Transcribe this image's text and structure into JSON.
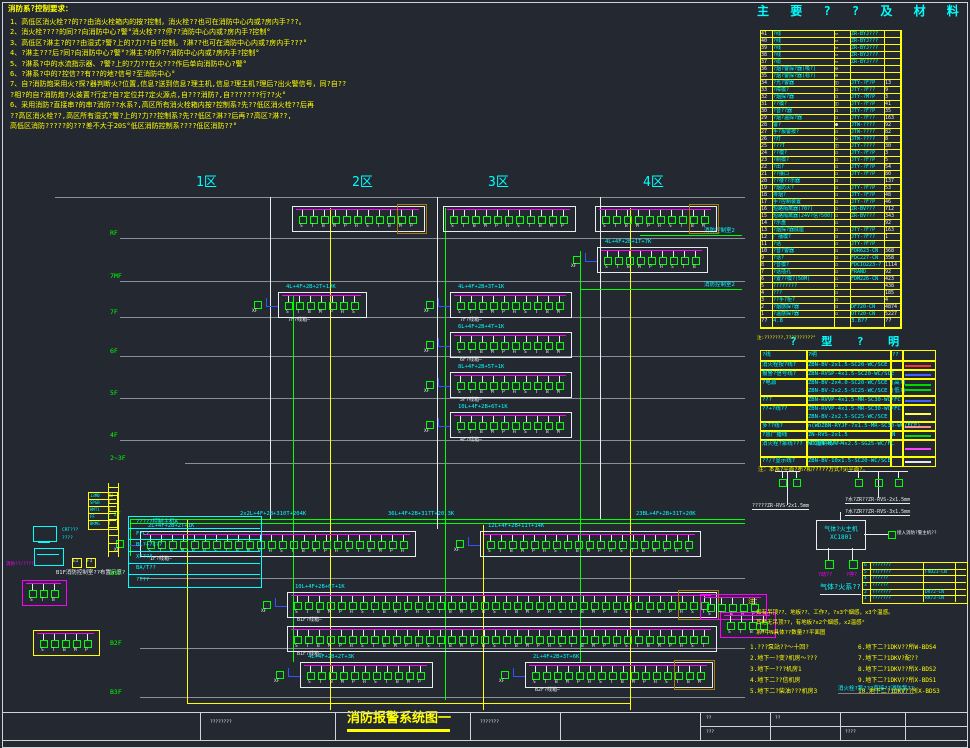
{
  "drawing_title": {
    "text": "消防报警系统图一"
  },
  "notes_top": {
    "header": "消防系?控制要求：",
    "lines": [
      "1、高低区消火栓??的??由消火栓箱内的按?控制，消火栓??也可在消防中心内或?房内手???。",
      "2、消火栓????的同??向消防中心?警°消火栓???停??消防中心内或?房内手?控制°",
      "3、高低区?淋主?的??由湿式?警?上的?力??自?控制。?淋??也可在消防中心内或?房内手???°",
      "4、?淋主???后?同?向消防中心?警°?淋主?的停??消防中心内或?房内手?控制°",
      "5、?淋系?中的水流指示器、?警?上的?力??在火???作后单向消防中心?警°",
      "6、?淋系?中的?控信??有??的地?信号?至消防中心°",
      "7、自?消防炮采用火?探?器判断火?位置,信息?送到信息?理主机,信息?理主机?理后?出火警信号，同?自??",
      "?相?的自?消防炮?火装置?行定?自?定位并?定火源点,自???消防?,自???????行??火°",
      "6、采用消防?直接串?的串?消防??水系?,高区所有消火栓箱内按?控制系?先??低区消火栓??后再",
      "??高区消火栓??,高区所有湿式?警?上的?力??控制系?先??低区?淋??后再??高区?淋??,",
      "高低区消防?????的???差不大于20S°低区消防控制系????低区消防??°"
    ]
  },
  "materials_table": {
    "title": "主 要 ? ? 及 材 料 表",
    "note": "注:???????,7?????????°",
    "rows": [
      [
        "41",
        "?线",
        "▭",
        "ZR-BYJ???",
        ""
      ],
      [
        "40",
        "?线",
        "▭",
        "ZR-BYJ???",
        ""
      ],
      [
        "39",
        "?线",
        "▭",
        "ZR-BYJ???",
        ""
      ],
      [
        "38",
        "?线",
        "▭",
        "ZR-BYJ???",
        ""
      ],
      [
        "37",
        "?缆",
        "▭",
        "ZR-BYJ???",
        ""
      ],
      [
        "36",
        "?烟?警探?器(吸?)",
        "⊖",
        "",
        ""
      ],
      [
        "35",
        "?烟?警探?器(标?)",
        "⊖",
        "",
        ""
      ],
      [
        "34",
        "?光?警器",
        "◫",
        "JTY-?F?P",
        "13"
      ],
      [
        "33",
        "?障模?",
        "◻",
        "JTY-?F??",
        "9"
      ],
      [
        "32",
        "?烟探?器",
        "◻",
        "JTY-?M?P",
        "3"
      ],
      [
        "31",
        "??模?",
        "◫",
        "JTY-?F?P",
        "41"
      ],
      [
        "30",
        "?音??器",
        "◻",
        "JTY-?F?P",
        "35"
      ],
      [
        "29",
        "?烟?温探?器",
        "◻",
        "JTY-?F??",
        "163"
      ],
      [
        "28",
        "警?",
        "●",
        "JTW-????",
        "92"
      ],
      [
        "27",
        "手?报警按?",
        "◻",
        "JTW-????",
        "82"
      ],
      [
        "26",
        "?灯",
        "◇",
        "JTW-????",
        "8"
      ],
      [
        "25",
        "???T",
        "◫",
        "JTY-????",
        "30"
      ],
      [
        "24",
        "??模?",
        "◻",
        "JTY-?F?P",
        "3"
      ],
      [
        "23",
        "?制模?",
        "◻",
        "JTY-?F?P",
        "5"
      ],
      [
        "22",
        "?出?",
        "◻",
        "JTY-?F?P",
        "54"
      ],
      [
        "21",
        "??接口",
        "◻",
        "JTY-?F?P",
        "80"
      ],
      [
        "20",
        "??楼??示器",
        "◻",
        "",
        "137"
      ],
      [
        "19",
        "?烟防火?",
        "◻",
        "JTY-?F?P",
        "53"
      ],
      [
        "18",
        "排烟?",
        "◻",
        "JTY-?F?P",
        "48"
      ],
      [
        "17",
        "手?控制装置",
        "◻",
        "JTY-?F?P",
        "46"
      ],
      [
        "16",
        "短路隔离器(70?)",
        "◻",
        "ZR-BV???",
        "712"
      ],
      [
        "15",
        "短路隔离器(24V?信?500)",
        "◻",
        "ZR-BV???",
        "343"
      ],
      [
        "14",
        "?示盘",
        "◻",
        "",
        "92"
      ],
      [
        "13",
        "?烟探?器底座",
        "◻",
        "JTY-?F?P",
        "163"
      ],
      [
        "12",
        "广播模?",
        "◻",
        "JTY-?F??",
        "1"
      ],
      [
        "11",
        "?话",
        "◻",
        "JTY-?F?P",
        ""
      ],
      [
        "10",
        "?音?警器",
        "◻",
        "FDR623-CN",
        "368"
      ],
      [
        "9",
        "?话?",
        "◻",
        "FDC227-CN",
        "358"
      ],
      [
        "8",
        "?音模?",
        "◻",
        "FDCIO223-?",
        "1114"
      ],
      [
        "7",
        "?话插孔",
        "◻",
        "FRAND",
        "92"
      ],
      [
        "6",
        "?置??模?(50M)",
        "◻",
        "FDM226-CN",
        "423"
      ],
      [
        "5",
        "????????",
        "◻",
        "",
        "438"
      ],
      [
        "4",
        "???",
        "◻",
        "",
        "185"
      ],
      [
        "3",
        "??手?柜?",
        "◻",
        "",
        "4"
      ],
      [
        "2",
        "?烟感探?器",
        "◻",
        "DF720-CN",
        "4874"
      ],
      [
        "1",
        "?温感探?器",
        "◻",
        "OT720-CN",
        "5227"
      ]
    ],
    "footer": [
      "??",
      "4.8",
      "",
      "3.8??",
      "??"
    ]
  },
  "cable_table": {
    "title": "? 型 ? 明",
    "headers": [
      "?线",
      "?明",
      "??",
      "?型??"
    ],
    "note": "注：本系?平面?布?和?????方式?见平面?。",
    "rows": [
      {
        "name": "消火栓按?线?",
        "specs": [
          "ZBN-BV-2x1.5-SC20-WC/SCE"
        ],
        "code": "",
        "colors": [
          "#ff3030"
        ]
      },
      {
        "name": "报警?信号线?",
        "specs": [
          "ZBN-RVSP-4x1.5-SC20-WC/SCE"
        ],
        "code": "",
        "colors": [
          "#4060ff"
        ]
      },
      {
        "name": "?电源",
        "specs": [
          "ZBN-BV-2x4.0-SC20-WC/SCE (高?)",
          "ZBN-BV-2x2.5-SC25-WC/SCE (低?)"
        ],
        "code": "",
        "colors": [
          "#00d800",
          "#00d800"
        ]
      },
      {
        "name": "???",
        "specs": [
          "ZBN-RVVP-4x1.5-MR-SC30-WC/FC"
        ],
        "code": "",
        "colors": [
          "#4060ff"
        ]
      },
      {
        "name": "??+?线??",
        "specs": [
          "ZBN-RVVP-4x1.5-MR-SC30-WC/FC",
          "ZBN-BV-2x2.5-SC25-WC/SCE"
        ],
        "code": "",
        "colors": [
          "#ffff50"
        ]
      },
      {
        "name": "多??线?",
        "specs": [
          "n(WDZBN-RYJF-7x1.5-MR-SC30-WC/FCE)"
        ],
        "code": "",
        "colors": [
          "#ff9090"
        ]
      },
      {
        "name": "?急广播线",
        "specs": [
          "ZN-RVS-2x1.5"
        ],
        "code": "N",
        "colors": [
          "#00d800"
        ]
      },
      {
        "name": "消火栓?泵线??? ???控制线???",
        "specs": [
          "WDZBN-KVV-4x2.5-SG25-WC/FC"
        ],
        "code": "",
        "colors": [
          "#ff40ff"
        ]
      },
      {
        "name": "??/?显示线?",
        "specs": [
          "ZBN-BV-10x1.5-SC20-WC/SCE"
        ],
        "code": "",
        "colors": [
          "#e8e8e8"
        ]
      }
    ]
  },
  "zones": {
    "labels": [
      "1区",
      "2区",
      "3区",
      "4区"
    ]
  },
  "floors": {
    "labels": [
      "RF",
      "7MF",
      "7F",
      "6F",
      "5F",
      "4F",
      "2~3F",
      "1F",
      "B1F",
      "B2F",
      "B3F"
    ]
  },
  "circuits": {
    "device_codes": [
      "S",
      "T",
      "B",
      "M",
      "P",
      "H"
    ],
    "bus_labels": [
      "2x2L+4F+2B+310T+204K",
      "36L+4F+2B+317T+20.3K",
      "23BL+4F+2B+31T+20K"
    ],
    "branch_labels": [
      "4L+4F+2B+1T+7K",
      "4L+4F+2B+2T+1JK",
      "4L+4F+2B+3T+1K",
      "6L+4F+2B+4T+1K",
      "8L+4F+2B+5T+1K",
      "10L+4F+2B+6T+1K",
      "2L+4F+2B+2T+1K",
      "12L+4F+2B+11T+14K",
      "10L+4F+2B+6T+1K",
      "4L+4F+2B+2T+3K",
      "2L+4F+2B+3T+6K"
    ],
    "captions": [
      "7F?线箱—",
      "6F?线箱—",
      "5F?线箱—",
      "4F?线箱—",
      "1F?线箱—",
      "B1F?线箱—",
      "B2F?线箱—"
    ],
    "right_labels": [
      "消防控制室2",
      "消防控制室2"
    ],
    "bottom_right_note": "消火栓?泵???直接??消防泵??"
  },
  "control_room": {
    "rows": [
      "?????控制主机A",
      "F?C?",
      "BL?+?C??",
      "XF??A",
      "BA/T??",
      "?T??"
    ],
    "caption": "B1F消防控制室??布置示意?",
    "side_labels": [
      "CRT???",
      "????"
    ],
    "magenta_label": "消防??/????",
    "mini_table": [
      [
        "13M0",
        "BU"
      ],
      [
        "SPGB",
        "T"
      ],
      [
        "HMT1",
        "B"
      ],
      [
        "FF",
        "F"
      ],
      [
        "BRMG",
        "T"
      ]
    ],
    "small_boxes": [
      "EI",
      "FI"
    ]
  },
  "gas_system": {
    "host_line1": "气体?火主机",
    "host_line2": "XC1801",
    "host_right_label": "接入消防?警主机??",
    "left_tree_label": "?????ZR-RVS-2x1.5mm",
    "right_tree_labels": [
      "?水?ZR??ZR-RVS-2x1.5mm",
      "?水?ZR??ZR-RVS-3x1.5mm"
    ],
    "buttons": [
      "?动??",
      "?停?"
    ],
    "subtitle": "气体?火系??",
    "table": [
      [
        "6",
        "???????",
        "",
        ""
      ],
      [
        "5",
        "??/????",
        "FVD23-CN",
        ""
      ],
      [
        "4",
        "??????",
        "",
        ""
      ],
      [
        "3",
        "??????",
        "",
        ""
      ],
      [
        "2",
        "???????",
        "DV72-CN",
        ""
      ],
      [
        "1",
        "???????",
        "RV73-CN",
        ""
      ]
    ]
  },
  "notes_bottom": {
    "header": "注：",
    "lines": [
      "如有吊顶??、地板??、工作?，?x3个烟感，x3个温感。",
      "其他无吊顶??，有地板?x2个烟感，x2温感°",
      "系?中N具体??数量??平面图"
    ],
    "items_left": [
      "1.???泵站??～十回?",
      "2.地下一?变?机房～???",
      "3.地下一???机房1",
      "4.地下二??信机房",
      "5.地下二?柴油???机房3"
    ],
    "items_right": [
      "6.地下二?1DKV??所W-BDS4",
      "7.地下二?1DKV?配??",
      "8.地下二?1DKV??所X-BDS2",
      "9.地下二?1DKV??所X-BDS1",
      "10.地下二?1DKV??所X-BDS3"
    ]
  },
  "title_block": {
    "cells": [
      "????????",
      "???????",
      "??",
      "???",
      "??",
      "????"
    ]
  }
}
